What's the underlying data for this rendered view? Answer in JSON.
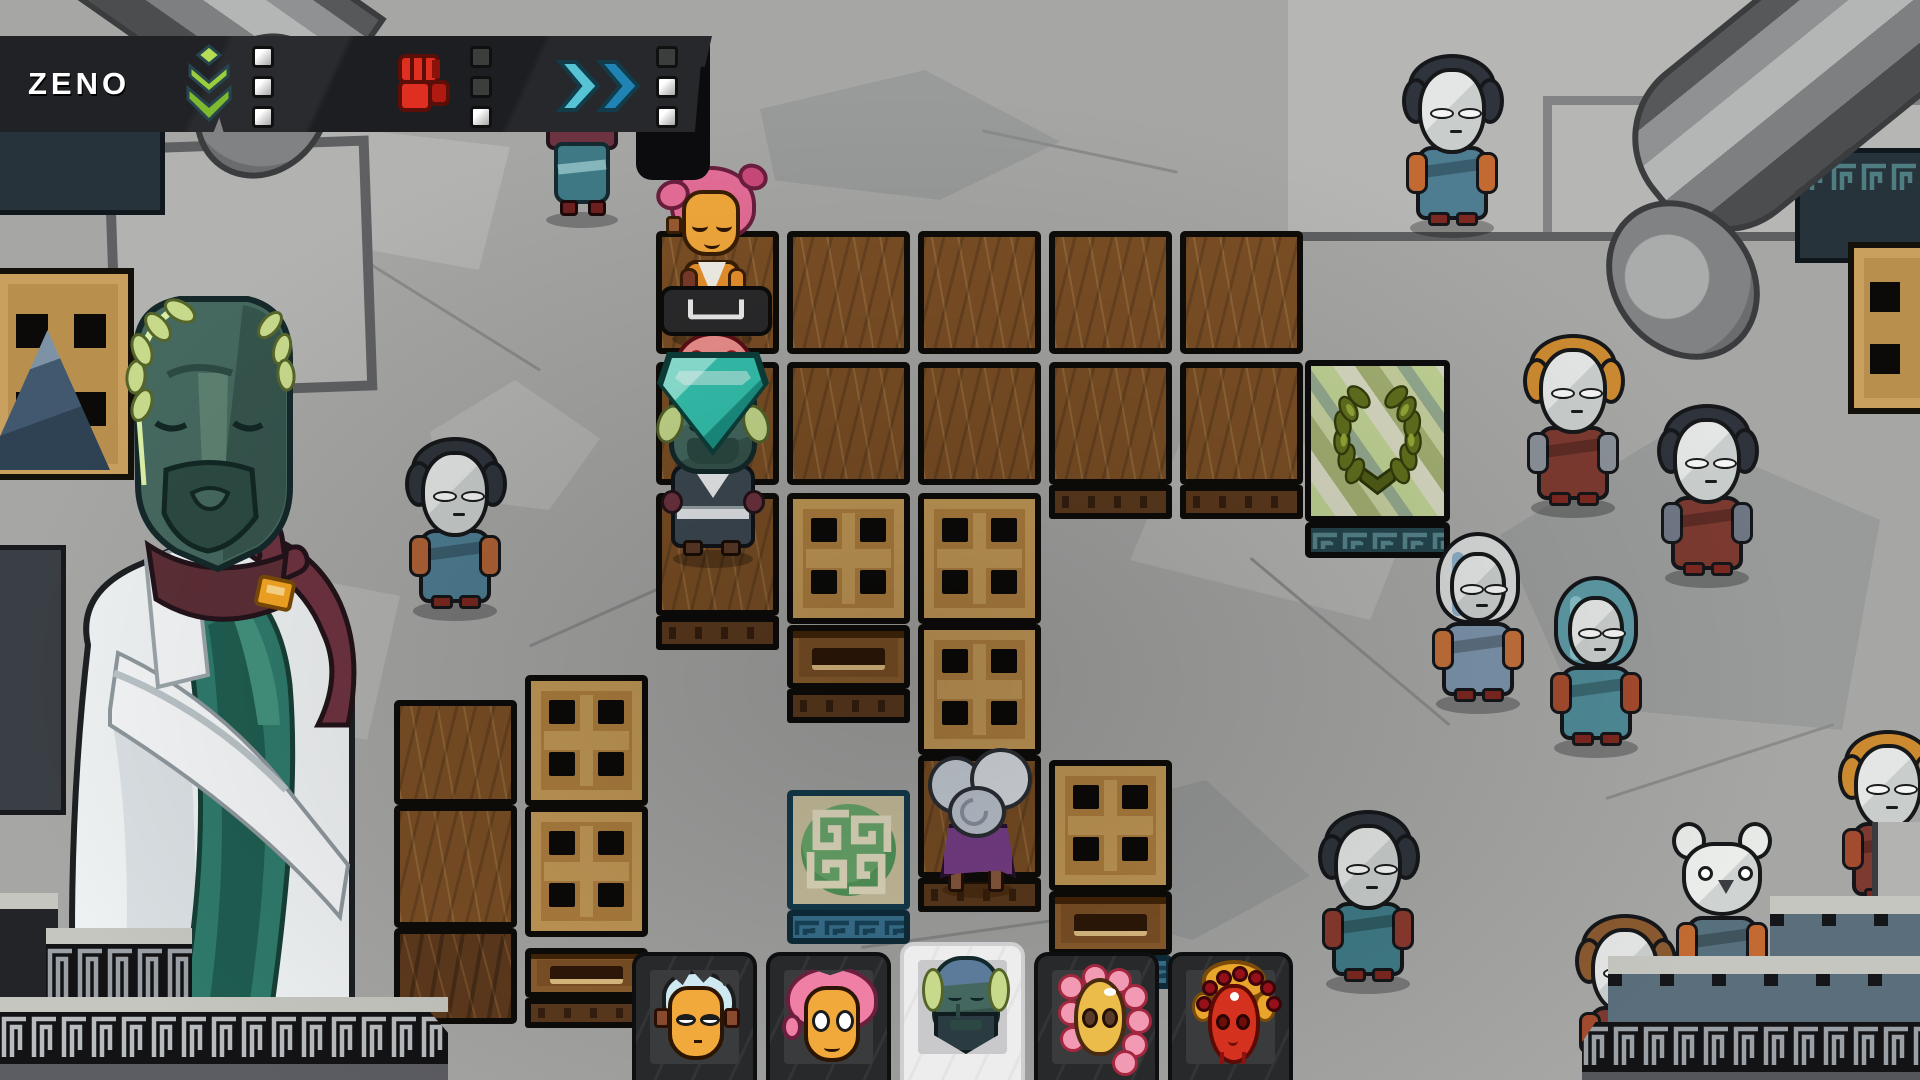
{
  "hud": {
    "player_name": "ZENO",
    "abilities": [
      {
        "id": "sprout",
        "icon": "sprout-icon",
        "color": "#9ccd3d",
        "charges": [
          1,
          1,
          1
        ]
      },
      {
        "id": "fist",
        "icon": "fist-icon",
        "color": "#df2f20",
        "charges": [
          0,
          0,
          1
        ]
      },
      {
        "id": "dash",
        "icon": "dash-icon",
        "color": "#2f9ec4",
        "charges": [
          0,
          1,
          1
        ]
      }
    ]
  },
  "prompt": {
    "key_hint": "space",
    "x": 660,
    "y": 286,
    "w": 112,
    "h": 50
  },
  "board": {
    "tiles": [
      {
        "t": "floor",
        "x": 656,
        "y": 231
      },
      {
        "t": "floor",
        "x": 787,
        "y": 231
      },
      {
        "t": "floor",
        "x": 918,
        "y": 231
      },
      {
        "t": "floor",
        "x": 1049,
        "y": 231
      },
      {
        "t": "floor",
        "x": 1180,
        "y": 231
      },
      {
        "t": "floor",
        "x": 656,
        "y": 362
      },
      {
        "t": "floor",
        "x": 787,
        "y": 362
      },
      {
        "t": "floor",
        "x": 918,
        "y": 362
      },
      {
        "t": "floor",
        "x": 1049,
        "y": 362
      },
      {
        "t": "floor",
        "x": 1180,
        "y": 362
      },
      {
        "t": "floor",
        "x": 656,
        "y": 493
      },
      {
        "t": "floor",
        "x": 918,
        "y": 755
      },
      {
        "t": "floor",
        "x": 394,
        "y": 700,
        "h": 105
      },
      {
        "t": "floor",
        "x": 394,
        "y": 805
      },
      {
        "t": "floor_dark",
        "x": 394,
        "y": 928,
        "h": 96
      },
      {
        "t": "edge",
        "x": 656,
        "y": 616,
        "h": 34
      },
      {
        "t": "edge",
        "x": 1049,
        "y": 485,
        "h": 34
      },
      {
        "t": "edge",
        "x": 1180,
        "y": 485,
        "h": 34
      },
      {
        "t": "edge",
        "x": 918,
        "y": 878,
        "h": 34
      },
      {
        "t": "edge",
        "x": 787,
        "y": 689,
        "h": 34
      },
      {
        "t": "edge",
        "x": 525,
        "y": 998,
        "h": 30
      },
      {
        "t": "crate",
        "x": 787,
        "y": 493,
        "h": 131
      },
      {
        "t": "crate",
        "x": 918,
        "y": 493,
        "h": 131
      },
      {
        "t": "crate",
        "x": 918,
        "y": 624,
        "h": 131
      },
      {
        "t": "crate",
        "x": 525,
        "y": 675,
        "h": 131
      },
      {
        "t": "crate",
        "x": 525,
        "y": 806,
        "h": 131
      },
      {
        "t": "crate",
        "x": 1049,
        "y": 760,
        "h": 131
      },
      {
        "t": "crate_slot",
        "x": 787,
        "y": 625,
        "h": 64
      },
      {
        "t": "crate_slot",
        "x": 525,
        "y": 948,
        "h": 50
      },
      {
        "t": "crate_slot",
        "x": 1049,
        "y": 891,
        "h": 64
      },
      {
        "t": "goal_meander",
        "x": 787,
        "y": 790,
        "h": 120
      },
      {
        "t": "goal_edge",
        "x": 787,
        "y": 910,
        "h": 34
      },
      {
        "t": "goal_edge",
        "x": 1049,
        "y": 955,
        "h": 34
      },
      {
        "t": "goal_wreath",
        "x": 1305,
        "y": 360,
        "w": 145,
        "h": 162
      },
      {
        "t": "wreath_edge",
        "x": 1305,
        "y": 522,
        "w": 145,
        "h": 36
      }
    ],
    "goal_icons": [
      "laurel-wreath",
      "meander-medallion"
    ],
    "characters": [
      {
        "id": "hero-pink",
        "x": 712,
        "y": 344
      },
      {
        "id": "hero-red",
        "x": 714,
        "y": 410
      },
      {
        "id": "hero-statue",
        "x": 713,
        "y": 564,
        "selected": true
      },
      {
        "id": "hero-cloud",
        "x": 978,
        "y": 896
      },
      {
        "id": "hero-blue",
        "x": 582,
        "y": 226,
        "note": "head hidden behind hud"
      }
    ],
    "selection_marker": {
      "x": 713,
      "y": 352,
      "w": 112,
      "h": 104
    }
  },
  "party": {
    "members": [
      {
        "id": "blue",
        "selected": false,
        "hair": "#cfe9f2",
        "face": "#f2a93b"
      },
      {
        "id": "pink",
        "selected": false,
        "hair": "#ef7fa4",
        "face": "#f2a93b"
      },
      {
        "id": "statue",
        "selected": true,
        "hair": "#c7da8c",
        "face": "#44685f"
      },
      {
        "id": "petal",
        "selected": false,
        "hair": "#f29ab3",
        "face": "#ecbc4a"
      },
      {
        "id": "crown",
        "selected": false,
        "hair": "#951018",
        "face": "#d4311f"
      }
    ]
  },
  "npcs": [
    {
      "x": 1452,
      "y": 232,
      "variant": "mask",
      "hair": "#2f343c",
      "robe": "#4e7d92",
      "sleeve": "#c26a32"
    },
    {
      "x": 1573,
      "y": 512,
      "variant": "mask",
      "hair": "#cc8a30",
      "robe": "#7c3a30",
      "sleeve": "#8a9098"
    },
    {
      "x": 1707,
      "y": 582,
      "variant": "mask",
      "hair": "#2f343c",
      "robe": "#7c3a30",
      "sleeve": "#6f7684"
    },
    {
      "x": 1478,
      "y": 708,
      "variant": "hood",
      "hood": "#d7dad9",
      "stripe": "#7fa6c2",
      "robe": "#7b93aa",
      "sleeve": "#c2703a"
    },
    {
      "x": 1596,
      "y": 752,
      "variant": "hood",
      "hood": "#5d99a4",
      "stripe": "#8fc4cc",
      "robe": "#4e8a96",
      "sleeve": "#a34b2e"
    },
    {
      "x": 455,
      "y": 615,
      "variant": "mask",
      "hair": "#2f343c",
      "robe": "#4e7d92",
      "sleeve": "#b06236"
    },
    {
      "x": 1368,
      "y": 988,
      "variant": "mask",
      "hair": "#2f343c",
      "robe": "#3f7a86",
      "sleeve": "#8a3a2e"
    },
    {
      "x": 1722,
      "y": 1002,
      "variant": "mouse",
      "hair": "#e8eae8",
      "robe": "#56707e",
      "sleeve": "#c26a32"
    },
    {
      "x": 1625,
      "y": 1092,
      "variant": "mask",
      "hair": "#8a5a30",
      "robe": "#7c3a30",
      "sleeve": "#a34b2e"
    },
    {
      "x": 1888,
      "y": 908,
      "variant": "mask",
      "hair": "#cc8a30",
      "robe": "#7c3a30",
      "sleeve": "#a34b2e"
    }
  ],
  "colors": {
    "stone": "#a6a7a5",
    "floor": "#7b4f25",
    "crate": "#b08040",
    "hud_bg": "#212225",
    "charge_on": "#f0f0ef",
    "charge_off": "#3c3e3e",
    "selection_teal": "#35c4b0",
    "goal_green": "#569a5c",
    "wreath_olive": "#5f6f1d",
    "statue_green": "#45685f",
    "selected_slot": "#ededee"
  }
}
